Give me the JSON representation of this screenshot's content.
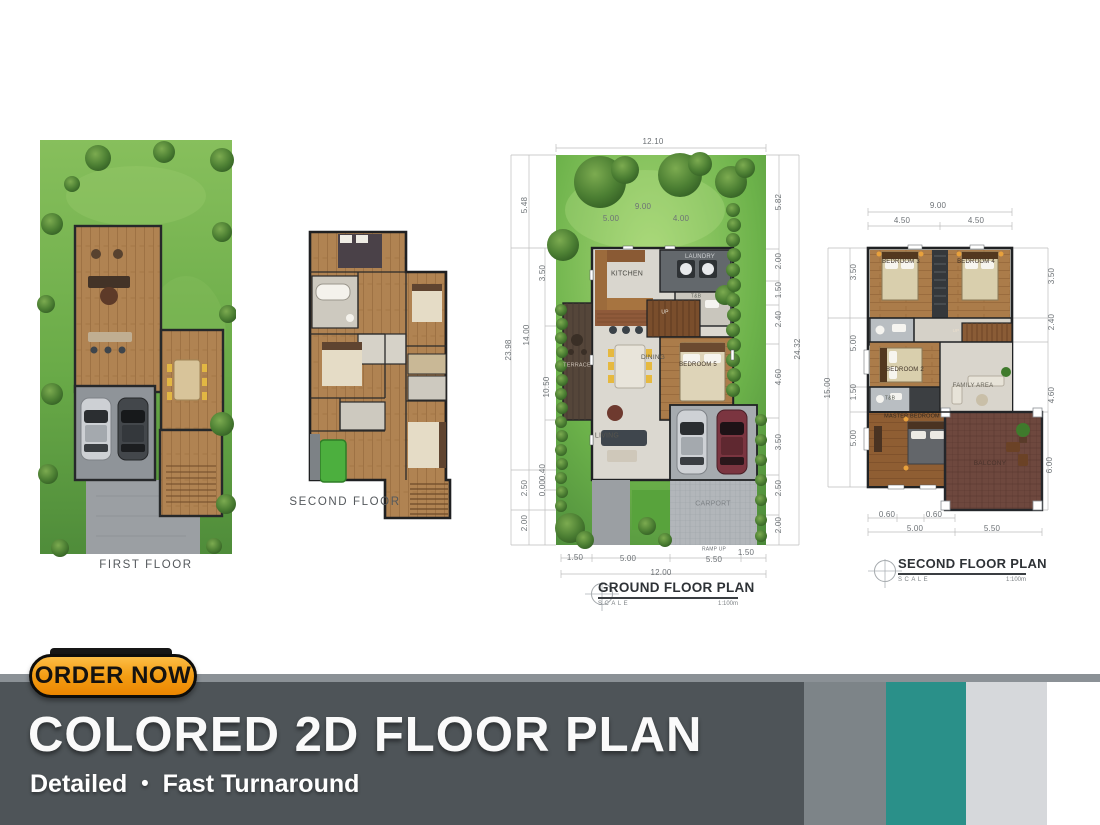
{
  "page": {
    "width": 1100,
    "height": 825,
    "background": "#ffffff"
  },
  "palette": {
    "banner_dark": "#4e5458",
    "banner_topline": "#8b9196",
    "stripe_mid_gray": "#7d8488",
    "stripe_teal": "#2a9089",
    "stripe_light_gray": "#d6d8db",
    "button_orange_top": "#fcb53b",
    "button_orange_bottom": "#ee8c00",
    "lawn_green": "#6fae4c",
    "tree_green": "#3c6e28",
    "wood_floor": "#b08352",
    "dim_text": "#6d7276"
  },
  "banner": {
    "button_label": "ORDER NOW",
    "title": "COLORED 2D FLOOR PLAN",
    "subtitle_left": "Detailed",
    "subtitle_bullet": "•",
    "subtitle_right": "Fast Turnaround"
  },
  "plan_first": {
    "label": "FIRST FLOOR"
  },
  "plan_second": {
    "label": "SECOND FLOOR"
  },
  "plan_ground": {
    "title": "GROUND FLOOR PLAN",
    "scale_label": "SCALE",
    "scale_value": "1:100m",
    "dim_labels": [
      {
        "t": "12.10",
        "x": 158,
        "y": 12
      },
      {
        "t": "9.00",
        "x": 148,
        "y": 77
      },
      {
        "t": "5.00",
        "x": 116,
        "y": 89
      },
      {
        "t": "4.00",
        "x": 186,
        "y": 89
      },
      {
        "t": "5.48",
        "x": 30,
        "y": 75,
        "r": 1
      },
      {
        "t": "3.50",
        "x": 48,
        "y": 143,
        "r": 1
      },
      {
        "t": "23.98",
        "x": 14,
        "y": 220,
        "r": 1
      },
      {
        "t": "14.00",
        "x": 32,
        "y": 205,
        "r": 1
      },
      {
        "t": "10.50",
        "x": 52,
        "y": 257,
        "r": 1
      },
      {
        "t": "0.40",
        "x": 48,
        "y": 342,
        "r": 1
      },
      {
        "t": "0.00",
        "x": 48,
        "y": 358,
        "r": 1
      },
      {
        "t": "2.50",
        "x": 30,
        "y": 358,
        "r": 1
      },
      {
        "t": "2.00",
        "x": 30,
        "y": 393,
        "r": 1
      },
      {
        "t": "5.82",
        "x": 284,
        "y": 72,
        "r": 1
      },
      {
        "t": "2.00",
        "x": 284,
        "y": 131,
        "r": 1
      },
      {
        "t": "1.50",
        "x": 284,
        "y": 160,
        "r": 1
      },
      {
        "t": "2.40",
        "x": 284,
        "y": 189,
        "r": 1
      },
      {
        "t": "4.60",
        "x": 284,
        "y": 247,
        "r": 1
      },
      {
        "t": "3.50",
        "x": 284,
        "y": 312,
        "r": 1
      },
      {
        "t": "2.50",
        "x": 284,
        "y": 358,
        "r": 1
      },
      {
        "t": "2.00",
        "x": 284,
        "y": 395,
        "r": 1
      },
      {
        "t": "24.32",
        "x": 303,
        "y": 219,
        "r": 1
      },
      {
        "t": "1.50",
        "x": 80,
        "y": 428
      },
      {
        "t": "5.00",
        "x": 133,
        "y": 429
      },
      {
        "t": "RAMP UP",
        "x": 219,
        "y": 420,
        "s": 5
      },
      {
        "t": "5.50",
        "x": 219,
        "y": 430
      },
      {
        "t": "1.50",
        "x": 251,
        "y": 423
      },
      {
        "t": "12.00",
        "x": 166,
        "y": 443
      }
    ],
    "room_labels": [
      {
        "t": "KITCHEN",
        "x": 132,
        "y": 144,
        "s": 7,
        "c": "#4a4a44"
      },
      {
        "t": "LAUNDRY",
        "x": 205,
        "y": 127,
        "s": 6,
        "c": "#cfd2d4"
      },
      {
        "t": "T&B",
        "x": 201,
        "y": 167,
        "s": 5,
        "c": "#62665e"
      },
      {
        "t": "UP",
        "x": 170,
        "y": 183,
        "s": 5,
        "c": "#ece5d8"
      },
      {
        "t": "DINING",
        "x": 158,
        "y": 228,
        "s": 6.5,
        "c": "#55544c"
      },
      {
        "t": "BEDROOM 5",
        "x": 203,
        "y": 235,
        "s": 6,
        "c": "#3f3228"
      },
      {
        "t": "TERRACE",
        "x": 82,
        "y": 236,
        "s": 5.5,
        "c": "#cfc5ba"
      },
      {
        "t": "LIVING",
        "x": 112,
        "y": 306,
        "s": 7,
        "c": "#56554e"
      },
      {
        "t": "CARPORT",
        "x": 218,
        "y": 374,
        "s": 7,
        "c": "#7e8387"
      }
    ]
  },
  "plan_upper": {
    "title": "SECOND FLOOR PLAN",
    "scale_label": "SCALE",
    "scale_value": "1:100m",
    "dim_labels": [
      {
        "t": "9.00",
        "x": 118,
        "y": 16
      },
      {
        "t": "4.50",
        "x": 82,
        "y": 31
      },
      {
        "t": "4.50",
        "x": 156,
        "y": 31
      },
      {
        "t": "15.00",
        "x": 8,
        "y": 198,
        "r": 1
      },
      {
        "t": "3.50",
        "x": 34,
        "y": 82,
        "r": 1
      },
      {
        "t": "5.00",
        "x": 34,
        "y": 153,
        "r": 1
      },
      {
        "t": "1.50",
        "x": 34,
        "y": 202,
        "r": 1
      },
      {
        "t": "5.00",
        "x": 34,
        "y": 248,
        "r": 1
      },
      {
        "t": "3.50",
        "x": 232,
        "y": 86,
        "r": 1
      },
      {
        "t": "2.40",
        "x": 232,
        "y": 132,
        "r": 1
      },
      {
        "t": "4.60",
        "x": 232,
        "y": 205,
        "r": 1
      },
      {
        "t": "6.00",
        "x": 230,
        "y": 275,
        "r": 1
      },
      {
        "t": "0.60",
        "x": 67,
        "y": 325
      },
      {
        "t": "0.60",
        "x": 114,
        "y": 325
      },
      {
        "t": "5.00",
        "x": 95,
        "y": 339
      },
      {
        "t": "5.50",
        "x": 172,
        "y": 339
      }
    ],
    "room_labels": [
      {
        "t": "BEDROOM 3",
        "x": 81,
        "y": 72,
        "s": 6,
        "c": "#3f3228"
      },
      {
        "t": "BEDROOM 4",
        "x": 156,
        "y": 72,
        "s": 6,
        "c": "#3f3228"
      },
      {
        "t": "UP",
        "x": 136,
        "y": 141,
        "s": 4.5,
        "c": "#ecdfcc"
      },
      {
        "t": "BEDROOM 2",
        "x": 85,
        "y": 180,
        "s": 6,
        "c": "#3f3228"
      },
      {
        "t": "T&B",
        "x": 70,
        "y": 209,
        "s": 5,
        "c": "#555a50"
      },
      {
        "t": "FAMILY AREA",
        "x": 153,
        "y": 196,
        "s": 6,
        "c": "#6b685e"
      },
      {
        "t": "MASTER BEDROOM",
        "x": 92,
        "y": 227,
        "s": 5.5,
        "c": "#32281e"
      },
      {
        "t": "BALCONY",
        "x": 170,
        "y": 274,
        "s": 6.5,
        "c": "#4a332c"
      }
    ]
  }
}
